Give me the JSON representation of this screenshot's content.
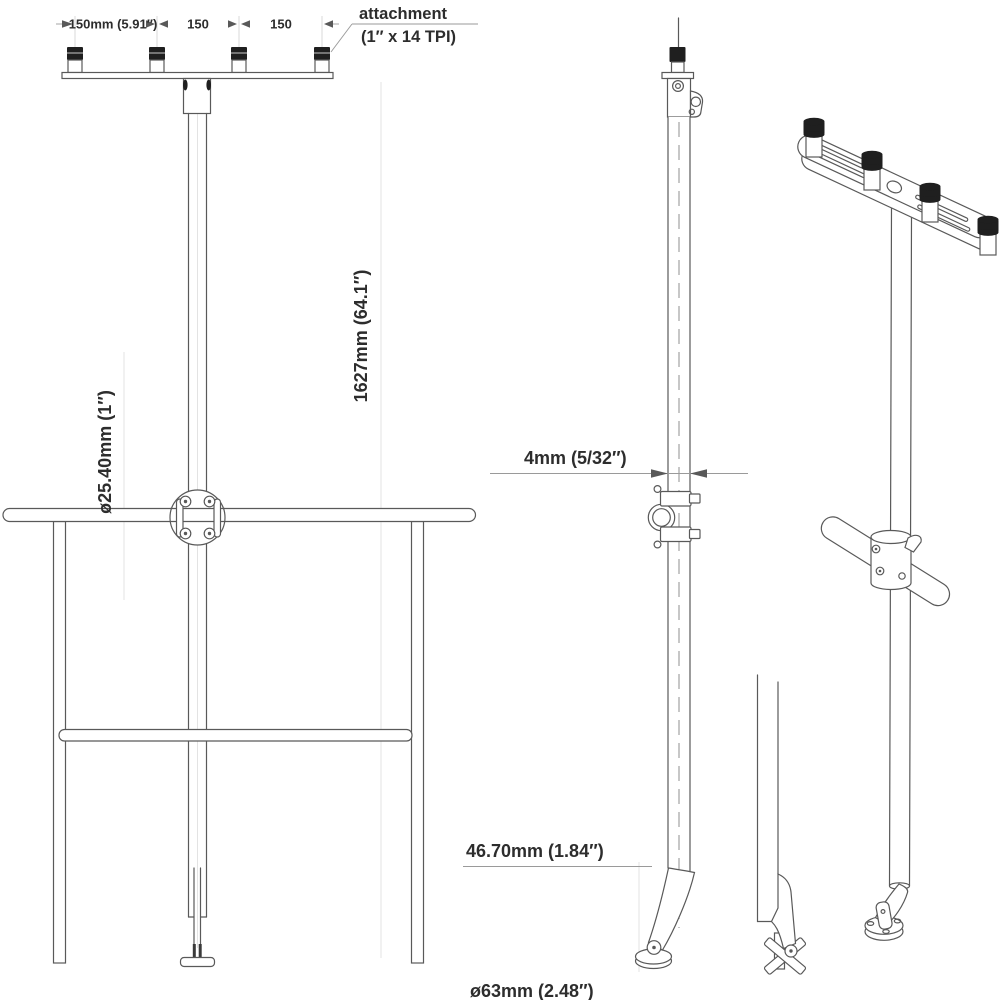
{
  "drawing_title": "rail mount rod holder pole - dimensioned technical drawing",
  "colors": {
    "background": "#ffffff",
    "line": "#595959",
    "cap": "#1f1f1f",
    "text": "#2d2d2d",
    "guide": "#d9d9d9"
  },
  "front_view": {
    "spacing_label_1": "150mm (5.91″)",
    "spacing_label_2": "150",
    "spacing_label_3": "150",
    "pole_diameter_label": "ø25.40mm (1″)",
    "pole_length_label": "1627mm (64.1″)"
  },
  "attachment_note": {
    "line1": "attachment",
    "line2": "(1″ x 14 TPI)"
  },
  "side_view": {
    "wall_thickness_label": "4mm (5/32″)",
    "base_offset_label": "46.70mm (1.84″)",
    "base_diameter_label": "ø63mm (2.48″)"
  }
}
